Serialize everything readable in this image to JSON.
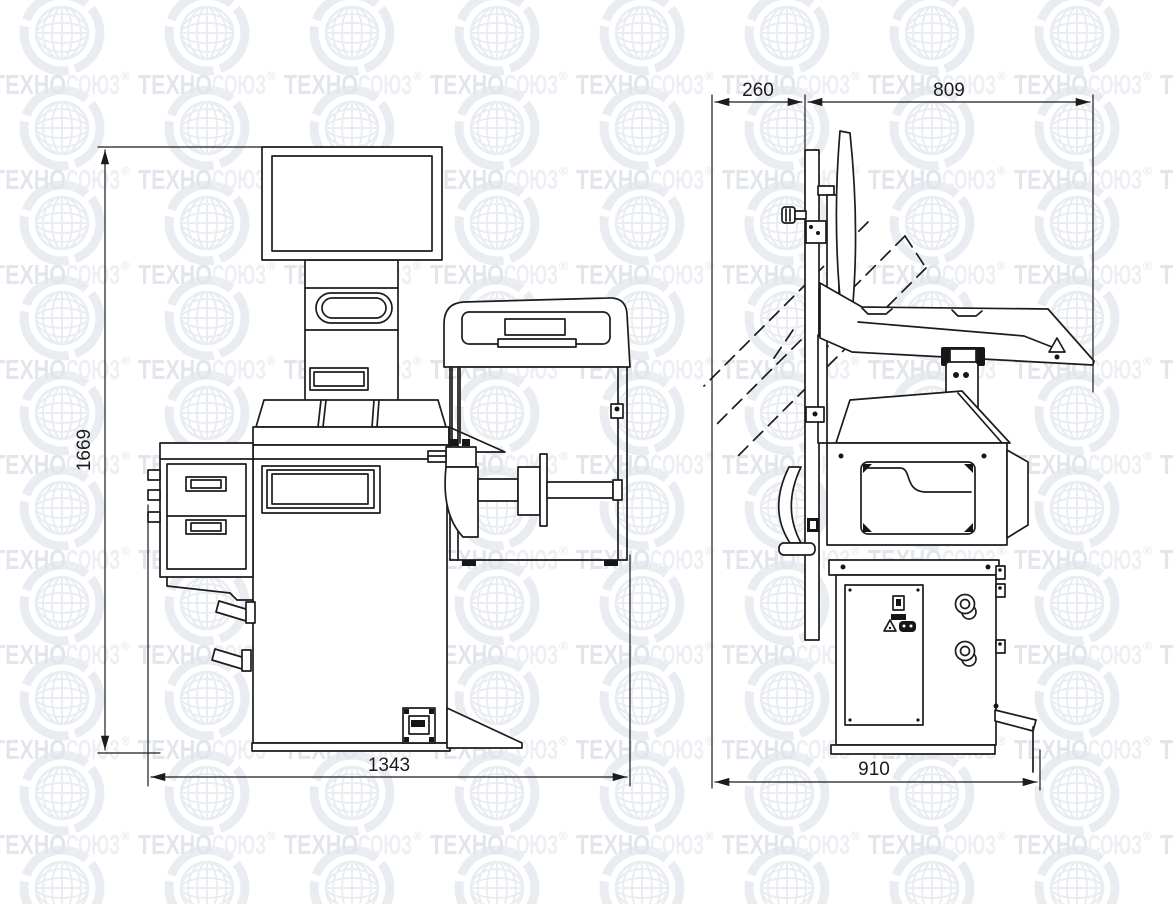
{
  "watermark": {
    "brand_prefix": "ТЕХНО",
    "brand_suffix": "СОЮЗ",
    "registered_mark": "®",
    "colors": {
      "prefix": "#e2e6ec",
      "suffix": "#edeff4",
      "globe": "#e9edf2"
    }
  },
  "drawing": {
    "line_color": "#1c1c1c",
    "background": "#ffffff",
    "dimensions": {
      "front_height": "1669",
      "front_width": "1343",
      "side_rear_depth": "260",
      "side_front_depth": "809",
      "side_overall_depth": "910"
    }
  }
}
